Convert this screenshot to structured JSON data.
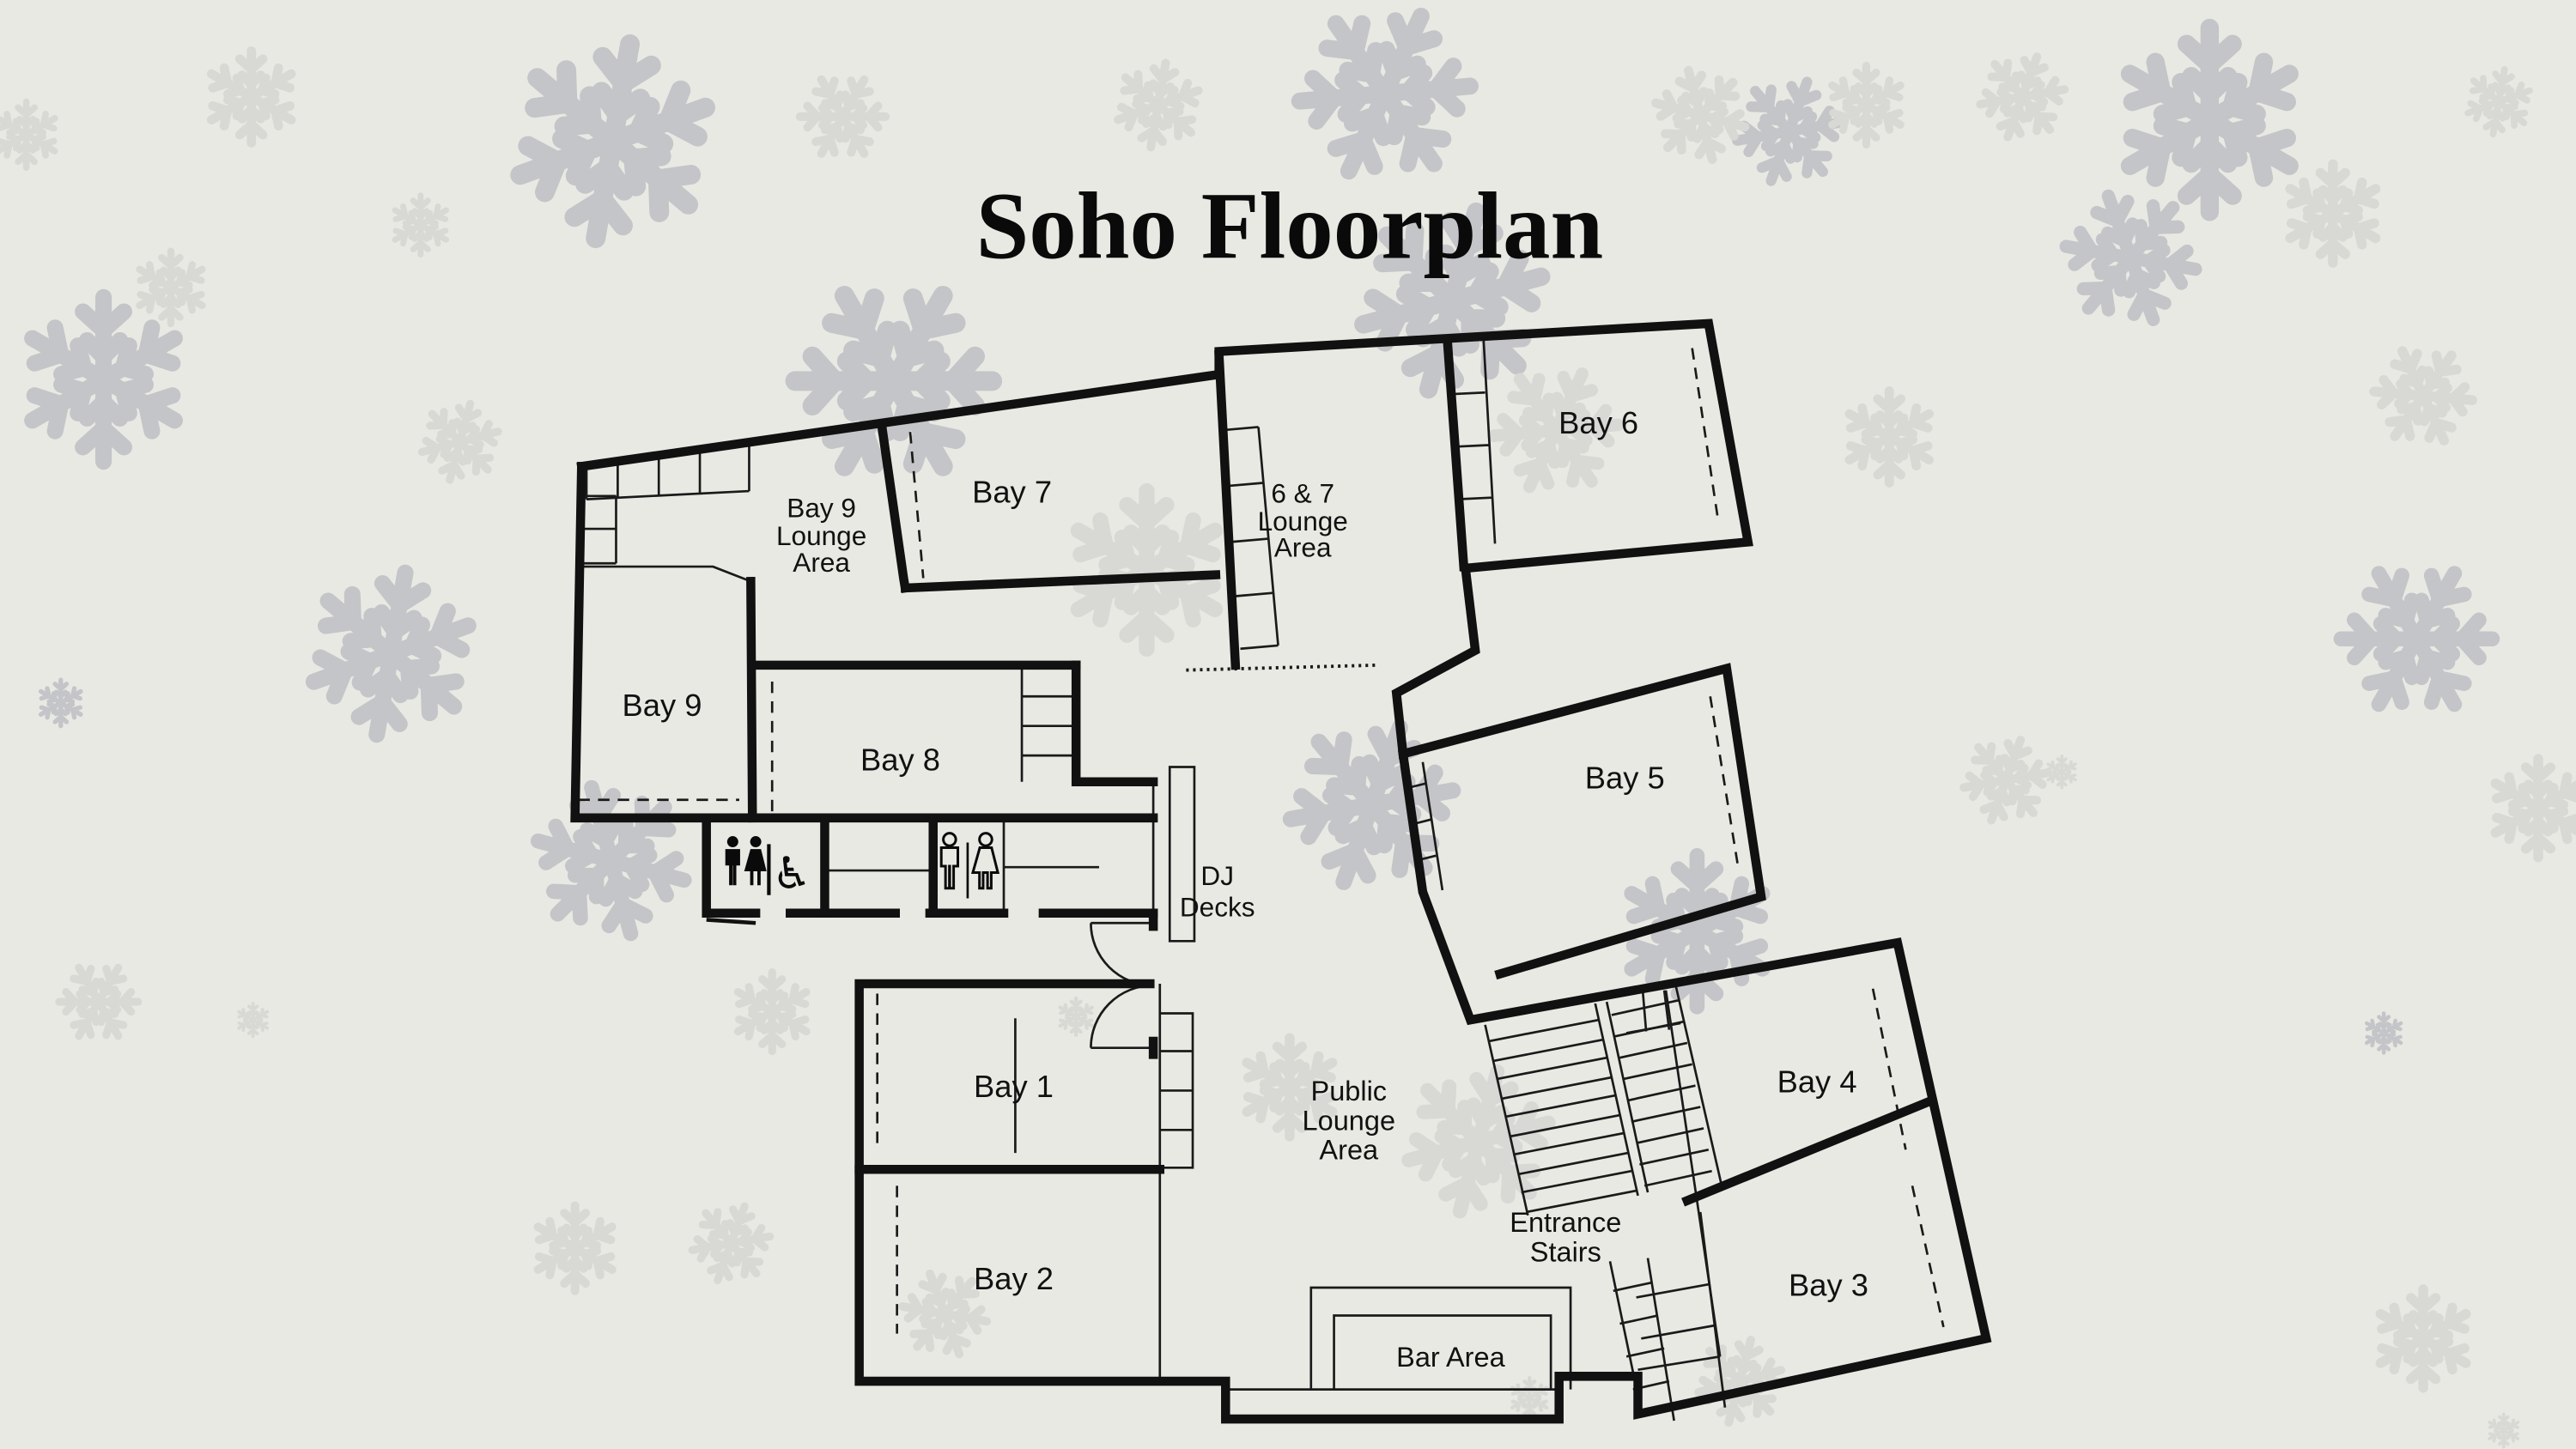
{
  "title": "Soho Floorplan",
  "colors": {
    "background": "#e9e9e4",
    "walls": "#111111",
    "snowflake_dark": "#c4c5c8",
    "snowflake_light": "#d8d8d4"
  },
  "rooms": {
    "bay9_lounge": [
      "Bay 9",
      "Lounge",
      "Area"
    ],
    "bay7": "Bay 7",
    "lounge67": [
      "6 & 7",
      "Lounge",
      "Area"
    ],
    "bay6": "Bay 6",
    "bay9": "Bay 9",
    "bay8": "Bay 8",
    "dj_decks": [
      "DJ",
      "Decks"
    ],
    "bay5": "Bay 5",
    "bay1": "Bay 1",
    "bay2": "Bay 2",
    "public_lounge": [
      "Public",
      "Lounge",
      "Area"
    ],
    "entrance_stairs": [
      "Entrance",
      "Stairs"
    ],
    "bay4": "Bay 4",
    "bay3": "Bay 3",
    "bar": "Bar Area"
  },
  "icons": {
    "toilet_group_filled": [
      "male-icon",
      "female-icon",
      "wheelchair-icon"
    ],
    "toilet_group_outline": [
      "male-icon",
      "female-icon"
    ],
    "wheelchair_glyph": "♿"
  }
}
